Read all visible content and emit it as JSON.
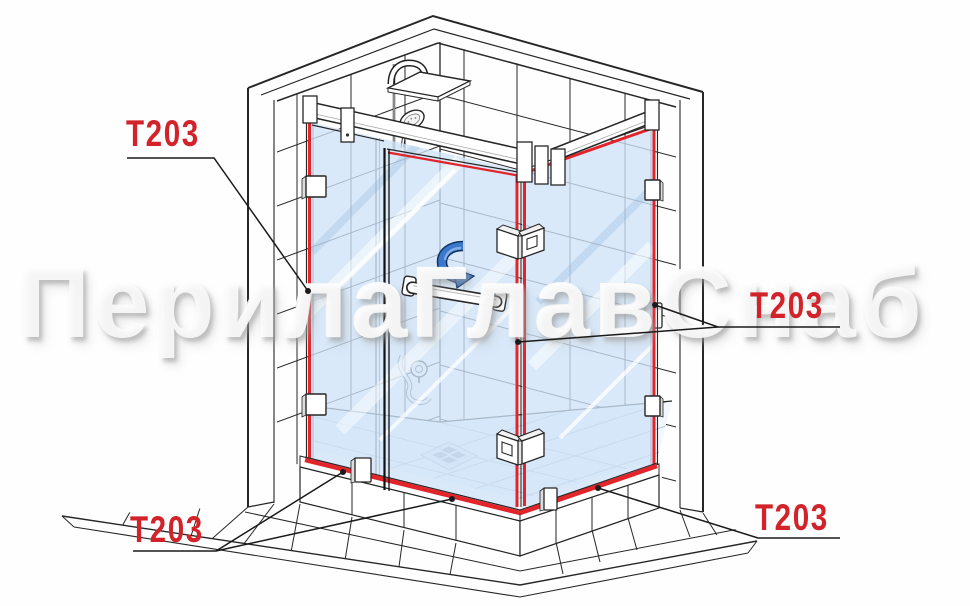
{
  "watermark": {
    "text": "ПерилаГлавСнаб"
  },
  "labels": {
    "top_left": "T203",
    "middle_right": "T203",
    "bottom_left": "T203",
    "bottom_right": "T203"
  },
  "colors": {
    "label_red": "#d2232a",
    "seal_red": "#e2242b",
    "line_dark": "#262626",
    "glass_blue": "#cee3f7",
    "arrow_blue": "#3a78cc",
    "watermark_white": "#fcfcfc"
  }
}
